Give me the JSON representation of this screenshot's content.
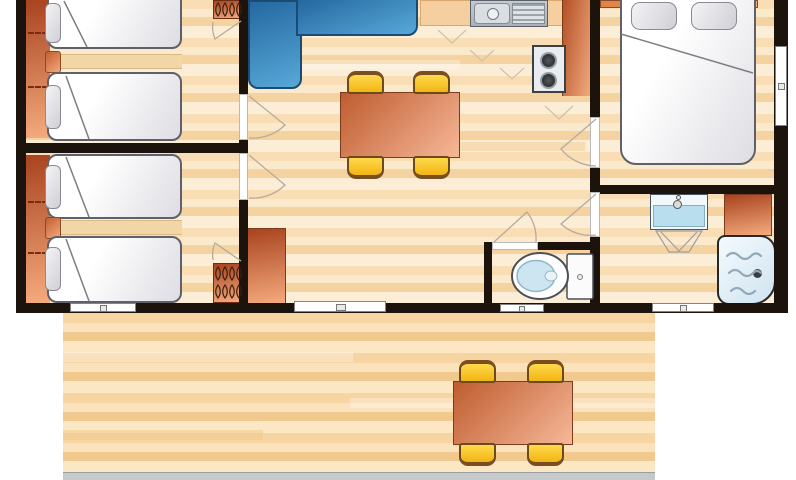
{
  "title": "Mobile home floor plan with terrace",
  "palette": {
    "wall": "#1C130C",
    "floor": "#F8DDB5",
    "floor_light": "#FCEDD6",
    "floor_dark": "#F4D3A0",
    "terrace_floor": "#F6D5A2",
    "deck_edge": "#C6C9CB",
    "furniture_orange_dark": "#A8431F",
    "furniture_orange_light": "#F5AB7D",
    "sofa_blue_dark": "#2468A0",
    "sofa_blue_light": "#58A8D8",
    "chair_yellow": "#FFD94A",
    "chair_frame_brown": "#6E4A1A",
    "table_salmon_dark": "#BF5C30",
    "table_salmon_light": "#F6B897",
    "bed_linen": "#FFFFFF",
    "pillow_grey": "#CFCFD6",
    "water_blue": "#CDE4F1",
    "stainless_steel": "#C9CED4"
  },
  "plan": {
    "rooms": [
      {
        "id": "bedroom-1",
        "label": "Twin bedroom (top left)",
        "furniture": [
          "single bed x2",
          "grey pillow x2",
          "bedside shelf with knob",
          "wardrobe shelving strip",
          "hanging closet with hangers"
        ]
      },
      {
        "id": "bedroom-2",
        "label": "Twin bedroom (bottom left)",
        "furniture": [
          "single bed x2",
          "grey pillow x2",
          "bedside shelf with knob",
          "wardrobe shelving strip",
          "hanging closet with hangers"
        ]
      },
      {
        "id": "living-kitchen",
        "label": "Living room / kitchen",
        "furniture": [
          "blue corner sofa",
          "dining table",
          "dining chair x4",
          "kitchen counter",
          "sink with drainer",
          "2-burner hob",
          "tall orange counter",
          "orange sideboard cabinet"
        ]
      },
      {
        "id": "bedroom-3",
        "label": "Double bedroom (top right)",
        "furniture": [
          "double bed",
          "pillow x2",
          "headboard"
        ]
      },
      {
        "id": "bathroom",
        "label": "Bathroom",
        "furniture": [
          "washbasin with pedestal",
          "orange storage cabinet",
          "bathtub"
        ]
      },
      {
        "id": "wc",
        "label": "Separate WC",
        "furniture": [
          "toilet with cistern"
        ]
      },
      {
        "id": "terrace",
        "label": "Wood deck terrace",
        "furniture": [
          "outdoor table",
          "outdoor chair x4"
        ]
      }
    ],
    "openings": {
      "interior_door_count": 5,
      "wardrobe_door_swing_count": 2,
      "bottom_wall_windows": 3,
      "sliding_bay_door_count": 1,
      "right_wall_window_count": 1
    }
  }
}
